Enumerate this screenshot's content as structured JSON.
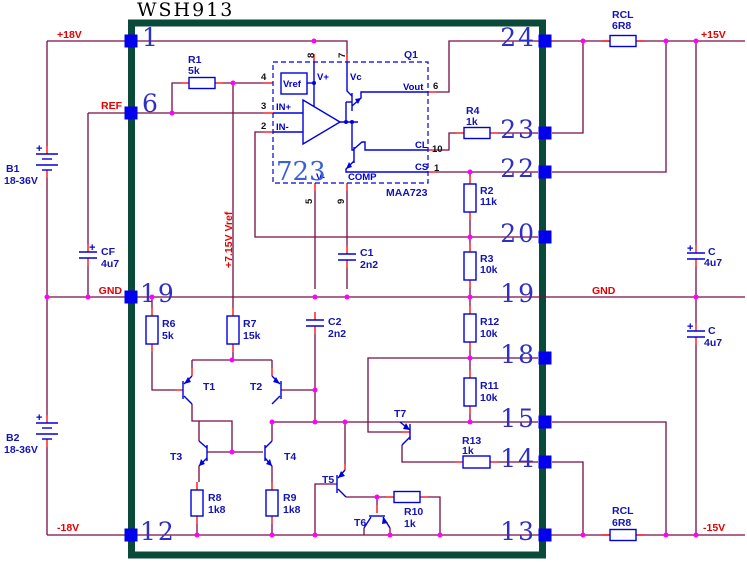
{
  "title": "WSH913",
  "symbols": {
    "plus": "+"
  },
  "nets": {
    "plus18": "+18V",
    "ref": "REF",
    "gnd": "GND",
    "minus18": "-18V",
    "gnd_right": "GND",
    "plus15": "+15V",
    "minus15": "-15V",
    "vref_rail": "+7.15V Vref"
  },
  "module": {
    "left_pins": [
      {
        "num": "1"
      },
      {
        "num": "6"
      },
      {
        "num": "19"
      },
      {
        "num": "12"
      }
    ],
    "right_pins": [
      {
        "num": "24"
      },
      {
        "num": "23"
      },
      {
        "num": "22"
      },
      {
        "num": "20"
      },
      {
        "num": "19"
      },
      {
        "num": "18"
      },
      {
        "num": "15"
      },
      {
        "num": "14"
      },
      {
        "num": "13"
      }
    ]
  },
  "ic": {
    "designator": "Q1",
    "big_label": "723",
    "part": "MAA723",
    "pin_labels": {
      "vplus": "V+",
      "vc": "Vc",
      "vref": "Vref",
      "inp": "IN+",
      "inn": "IN-",
      "vout": "Vout",
      "cl": "CL",
      "cs": "CS",
      "vminus": "V-",
      "comp": "COMP"
    },
    "pin_numbers": {
      "vplus": "8",
      "vc": "7",
      "vref": "4",
      "inp": "3",
      "inn": "2",
      "vout": "6",
      "cl": "10",
      "cs": "1",
      "vminus": "5",
      "comp": "9"
    }
  },
  "resistors": [
    {
      "ref": "R1",
      "value": "5k"
    },
    {
      "ref": "R2",
      "value": "11k"
    },
    {
      "ref": "R3",
      "value": "10k"
    },
    {
      "ref": "R4",
      "value": "1k"
    },
    {
      "ref": "R6",
      "value": "5k"
    },
    {
      "ref": "R7",
      "value": "15k"
    },
    {
      "ref": "R8",
      "value": "1k8"
    },
    {
      "ref": "R9",
      "value": "1k8"
    },
    {
      "ref": "R10",
      "value": "1k"
    },
    {
      "ref": "R11",
      "value": "10k"
    },
    {
      "ref": "R12",
      "value": "10k"
    },
    {
      "ref": "R13",
      "value": "1k"
    }
  ],
  "rcl": [
    {
      "ref": "RCL",
      "value": "6R8"
    },
    {
      "ref": "RCL",
      "value": "6R8"
    }
  ],
  "capacitors": [
    {
      "ref": "CF",
      "value": "4u7"
    },
    {
      "ref": "C1",
      "value": "2n2"
    },
    {
      "ref": "C2",
      "value": "2n2"
    },
    {
      "ref": "C",
      "value": "4u7"
    },
    {
      "ref": "C",
      "value": "4u7"
    }
  ],
  "batteries": [
    {
      "ref": "B1",
      "value": "18-36V"
    },
    {
      "ref": "B2",
      "value": "18-36V"
    }
  ],
  "transistors": [
    {
      "ref": "T1"
    },
    {
      "ref": "T2"
    },
    {
      "ref": "T3"
    },
    {
      "ref": "T4"
    },
    {
      "ref": "T5"
    },
    {
      "ref": "T6"
    },
    {
      "ref": "T7"
    }
  ]
}
